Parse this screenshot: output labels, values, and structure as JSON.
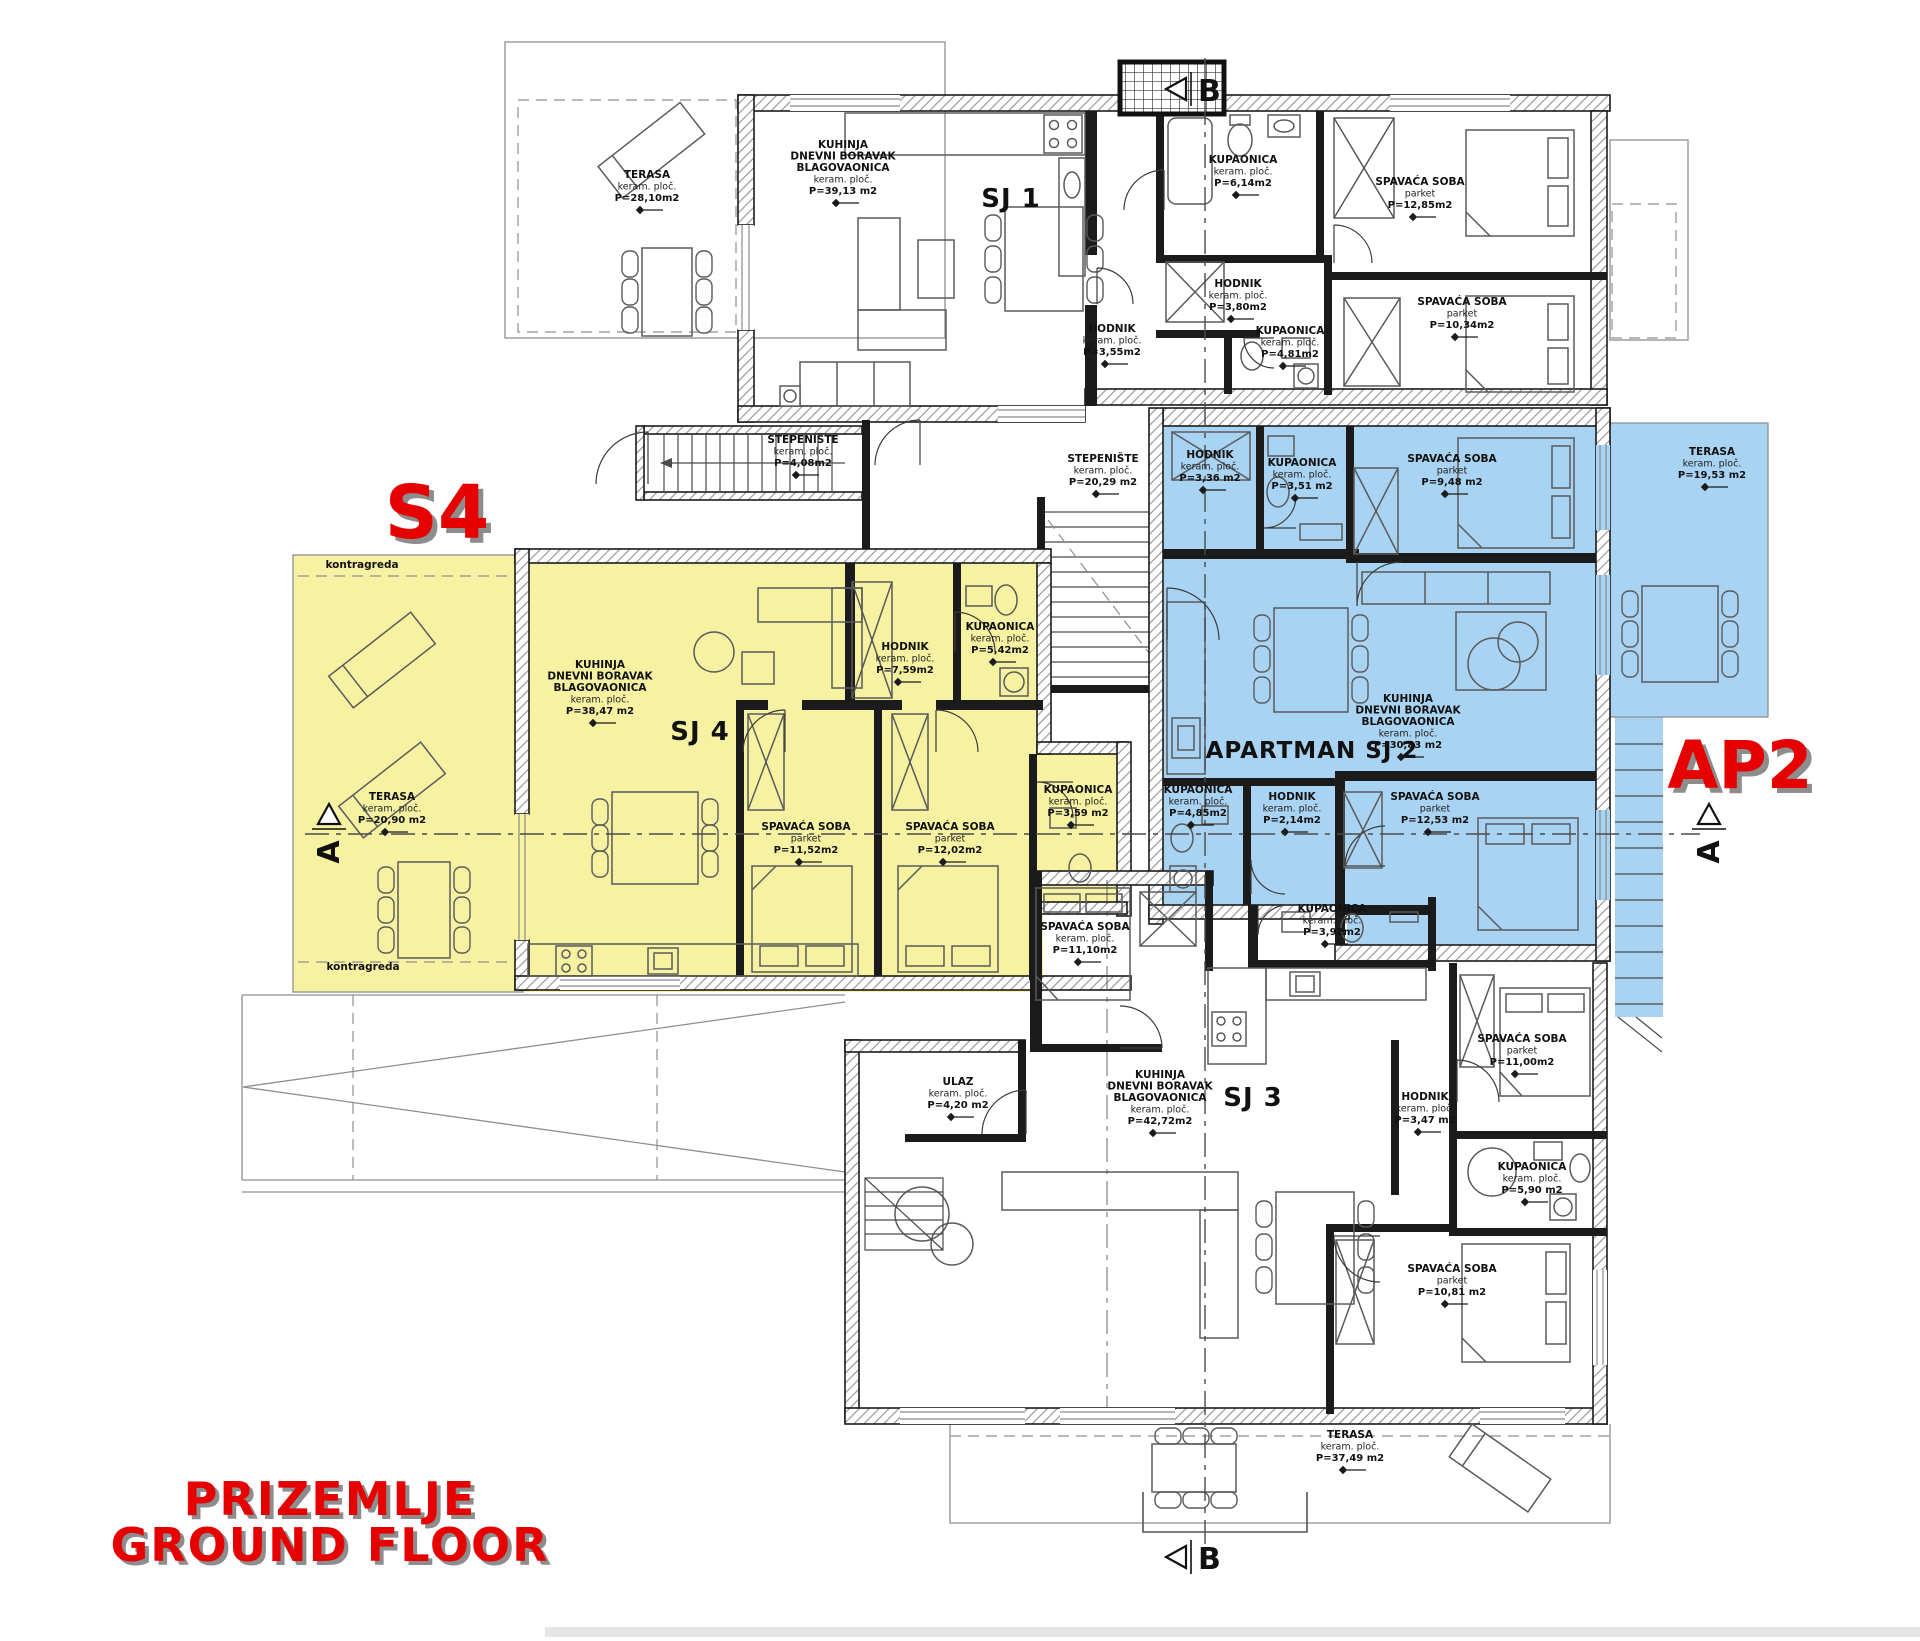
{
  "floor_title": {
    "line1": "PRIZEMLJE",
    "line2": "GROUND FLOOR"
  },
  "highlights": {
    "s4": "S4",
    "ap2": "AP2"
  },
  "colors": {
    "unit_s4_fill": "#f6f2a2",
    "unit_ap2_fill": "#a9d3f2",
    "accent_red": "#e60000"
  },
  "section_markers": {
    "a": "A",
    "b": "B"
  },
  "units": [
    {
      "id": "sj1",
      "label": "SJ 1",
      "x": 1011,
      "y": 207,
      "size": 26
    },
    {
      "id": "sj4",
      "label": "SJ 4",
      "x": 700,
      "y": 740,
      "size": 26
    },
    {
      "id": "sj2",
      "label": "APARTMAN SJ 2",
      "x": 1312,
      "y": 758,
      "size": 23
    },
    {
      "id": "sj3",
      "label": "SJ 3",
      "x": 1253,
      "y": 1106,
      "size": 26
    }
  ],
  "rooms": [
    {
      "n": "TERASA",
      "m": "keram. ploč.",
      "a": "P=28,10m2",
      "x": 647,
      "y": 178
    },
    {
      "n": "KUHINJA",
      "n2": "DNEVNI BORAVAK",
      "n3": "BLAGOVAONICA",
      "m": "keram. ploč.",
      "a": "P=39,13 m2",
      "x": 843,
      "y": 148
    },
    {
      "n": "HODNIK",
      "m": "keram. ploč.",
      "a": "P=3,55m2",
      "x": 1112,
      "y": 332
    },
    {
      "n": "KUPAONICA",
      "m": "keram. ploč.",
      "a": "P=6,14m2",
      "x": 1243,
      "y": 163
    },
    {
      "n": "SPAVAĆA SOBA",
      "m": "parket",
      "a": "P=12,85m2",
      "x": 1420,
      "y": 185
    },
    {
      "n": "HODNIK",
      "m": "keram. ploč.",
      "a": "P=3,80m2",
      "x": 1238,
      "y": 287
    },
    {
      "n": "KUPAONICA",
      "m": "keram. ploč.",
      "a": "P=4,81m2",
      "x": 1290,
      "y": 334
    },
    {
      "n": "SPAVAĆA SOBA",
      "m": "parket",
      "a": "P=10,34m2",
      "x": 1462,
      "y": 305
    },
    {
      "n": "STEPENIŠTE",
      "m": "keram. ploč.",
      "a": "P=4,08m2",
      "x": 803,
      "y": 443
    },
    {
      "n": "STEPENIŠTE",
      "m": "keram. ploč.",
      "a": "P=20,29 m2",
      "x": 1103,
      "y": 462
    },
    {
      "n": "kontragreda",
      "x": 362,
      "y": 568
    },
    {
      "n": "TERASA",
      "m": "keram. ploč.",
      "a": "P=20,90 m2",
      "x": 392,
      "y": 800
    },
    {
      "n": "KUHINJA",
      "n2": "DNEVNI BORAVAK",
      "n3": "BLAGOVAONICA",
      "m": "keram. ploč.",
      "a": "P=38,47 m2",
      "x": 600,
      "y": 668
    },
    {
      "n": "HODNIK",
      "m": "keram. ploč.",
      "a": "P=7,59m2",
      "x": 905,
      "y": 650
    },
    {
      "n": "KUPAONICA",
      "m": "keram. ploč.",
      "a": "P=5,42m2",
      "x": 1000,
      "y": 630
    },
    {
      "n": "SPAVAĆA SOBA",
      "m": "parket",
      "a": "P=11,52m2",
      "x": 806,
      "y": 830
    },
    {
      "n": "SPAVAĆA SOBA",
      "m": "parket",
      "a": "P=12,02m2",
      "x": 950,
      "y": 830
    },
    {
      "n": "KUPAONICA",
      "m": "keram. ploč.",
      "a": "P=3,59 m2",
      "x": 1078,
      "y": 793
    },
    {
      "n": "kontragreda",
      "x": 363,
      "y": 970
    },
    {
      "n": "HODNIK",
      "m": "keram. ploč.",
      "a": "P=3,36 m2",
      "x": 1210,
      "y": 458
    },
    {
      "n": "KUPAONICA",
      "m": "keram. ploč.",
      "a": "P=3,51 m2",
      "x": 1302,
      "y": 466
    },
    {
      "n": "SPAVAĆA SOBA",
      "m": "parket",
      "a": "P=9,48 m2",
      "x": 1452,
      "y": 462
    },
    {
      "n": "TERASA",
      "m": "keram. ploč.",
      "a": "P=19,53 m2",
      "x": 1712,
      "y": 455
    },
    {
      "n": "KUHINJA",
      "n2": "DNEVNI BORAVAK",
      "n3": "BLAGOVAONICA",
      "m": "keram. ploč.",
      "a": "P=30,83 m2",
      "x": 1408,
      "y": 702
    },
    {
      "n": "HODNIK",
      "m": "keram. ploč.",
      "a": "P=2,14m2",
      "x": 1292,
      "y": 800
    },
    {
      "n": "KUPAONICA",
      "m": "keram. ploč.",
      "a": "P=4,85m2",
      "x": 1198,
      "y": 793
    },
    {
      "n": "SPAVAĆA SOBA",
      "m": "parket",
      "a": "P=12,53 m2",
      "x": 1435,
      "y": 800
    },
    {
      "n": "KUPAONICA",
      "m": "keram. ploč.",
      "a": "P=3,92m2",
      "x": 1332,
      "y": 912
    },
    {
      "n": "SPAVAĆA SOBA",
      "m": "keram. ploč.",
      "a": "P=11,10m2",
      "x": 1085,
      "y": 930
    },
    {
      "n": "ULAZ",
      "m": "keram. ploč.",
      "a": "P=4,20 m2",
      "x": 958,
      "y": 1085
    },
    {
      "n": "KUHINJA",
      "n2": "DNEVNI BORAVAK",
      "n3": "BLAGOVAONICA",
      "m": "keram. ploč.",
      "a": "P=42,72m2",
      "x": 1160,
      "y": 1078
    },
    {
      "n": "HODNIK",
      "m": "keram. ploč.",
      "a": "P=3,47 m2",
      "x": 1425,
      "y": 1100
    },
    {
      "n": "SPAVAĆA SOBA",
      "m": "parket",
      "a": "P=11,00m2",
      "x": 1522,
      "y": 1042
    },
    {
      "n": "KUPAONICA",
      "m": "keram. ploč.",
      "a": "P=5,90 m2",
      "x": 1532,
      "y": 1170
    },
    {
      "n": "SPAVAĆA SOBA",
      "m": "parket",
      "a": "P=10,81 m2",
      "x": 1452,
      "y": 1272
    },
    {
      "n": "TERASA",
      "m": "keram. ploč.",
      "a": "P=37,49 m2",
      "x": 1350,
      "y": 1438
    }
  ]
}
